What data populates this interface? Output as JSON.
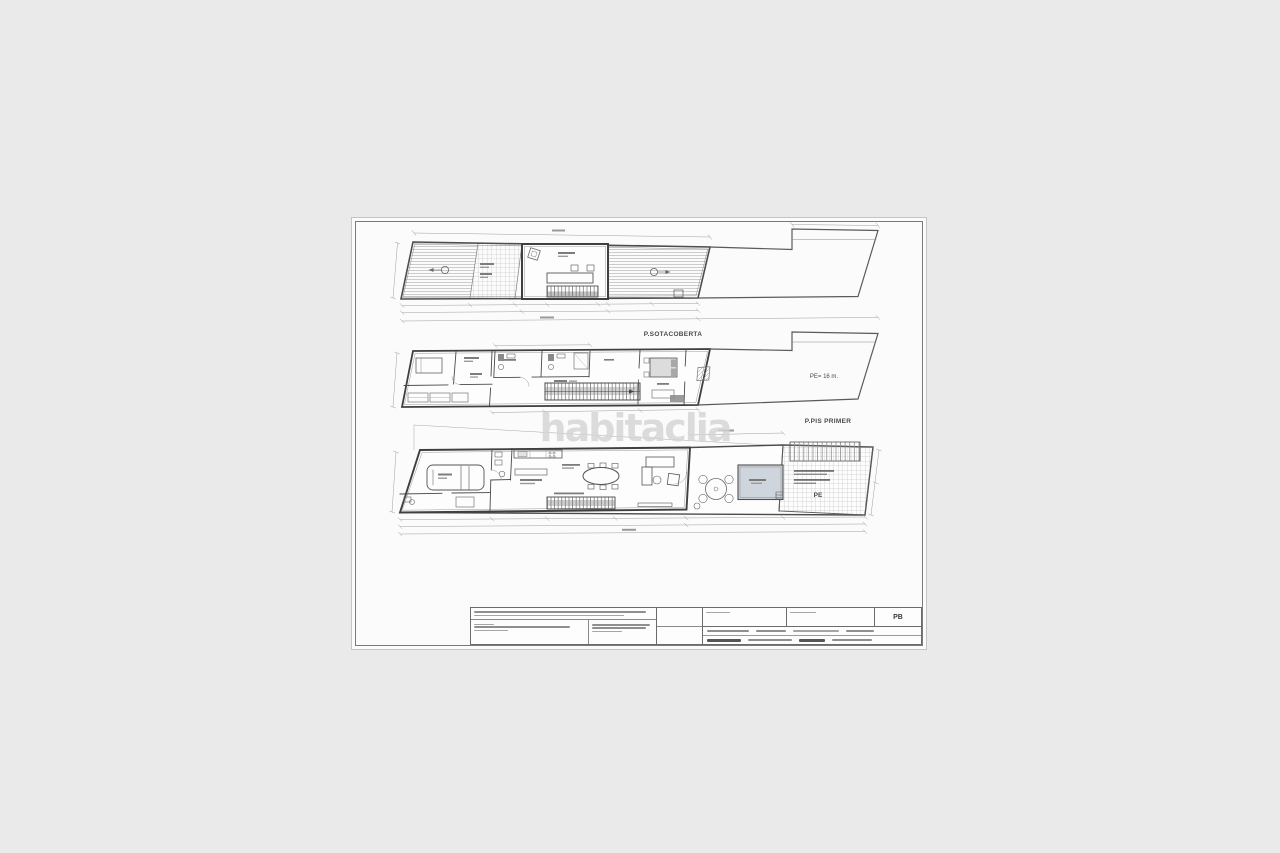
{
  "watermark": {
    "text": "habitaclia"
  },
  "plans": {
    "roof": {
      "label": "P.SOTACOBERTA"
    },
    "first": {
      "label": "P.PIS PRIMER",
      "height_note": "PE= 16 m."
    },
    "ground": {
      "zone_note": "PE"
    }
  },
  "title_block": {
    "sheet_code": "PB"
  },
  "colors": {
    "background": "#eaeaea",
    "paper": "#fbfbfb",
    "ink": "#4a4a4a",
    "watermark": "#d4d4d4",
    "pool_fill": "#cfd5dc"
  }
}
